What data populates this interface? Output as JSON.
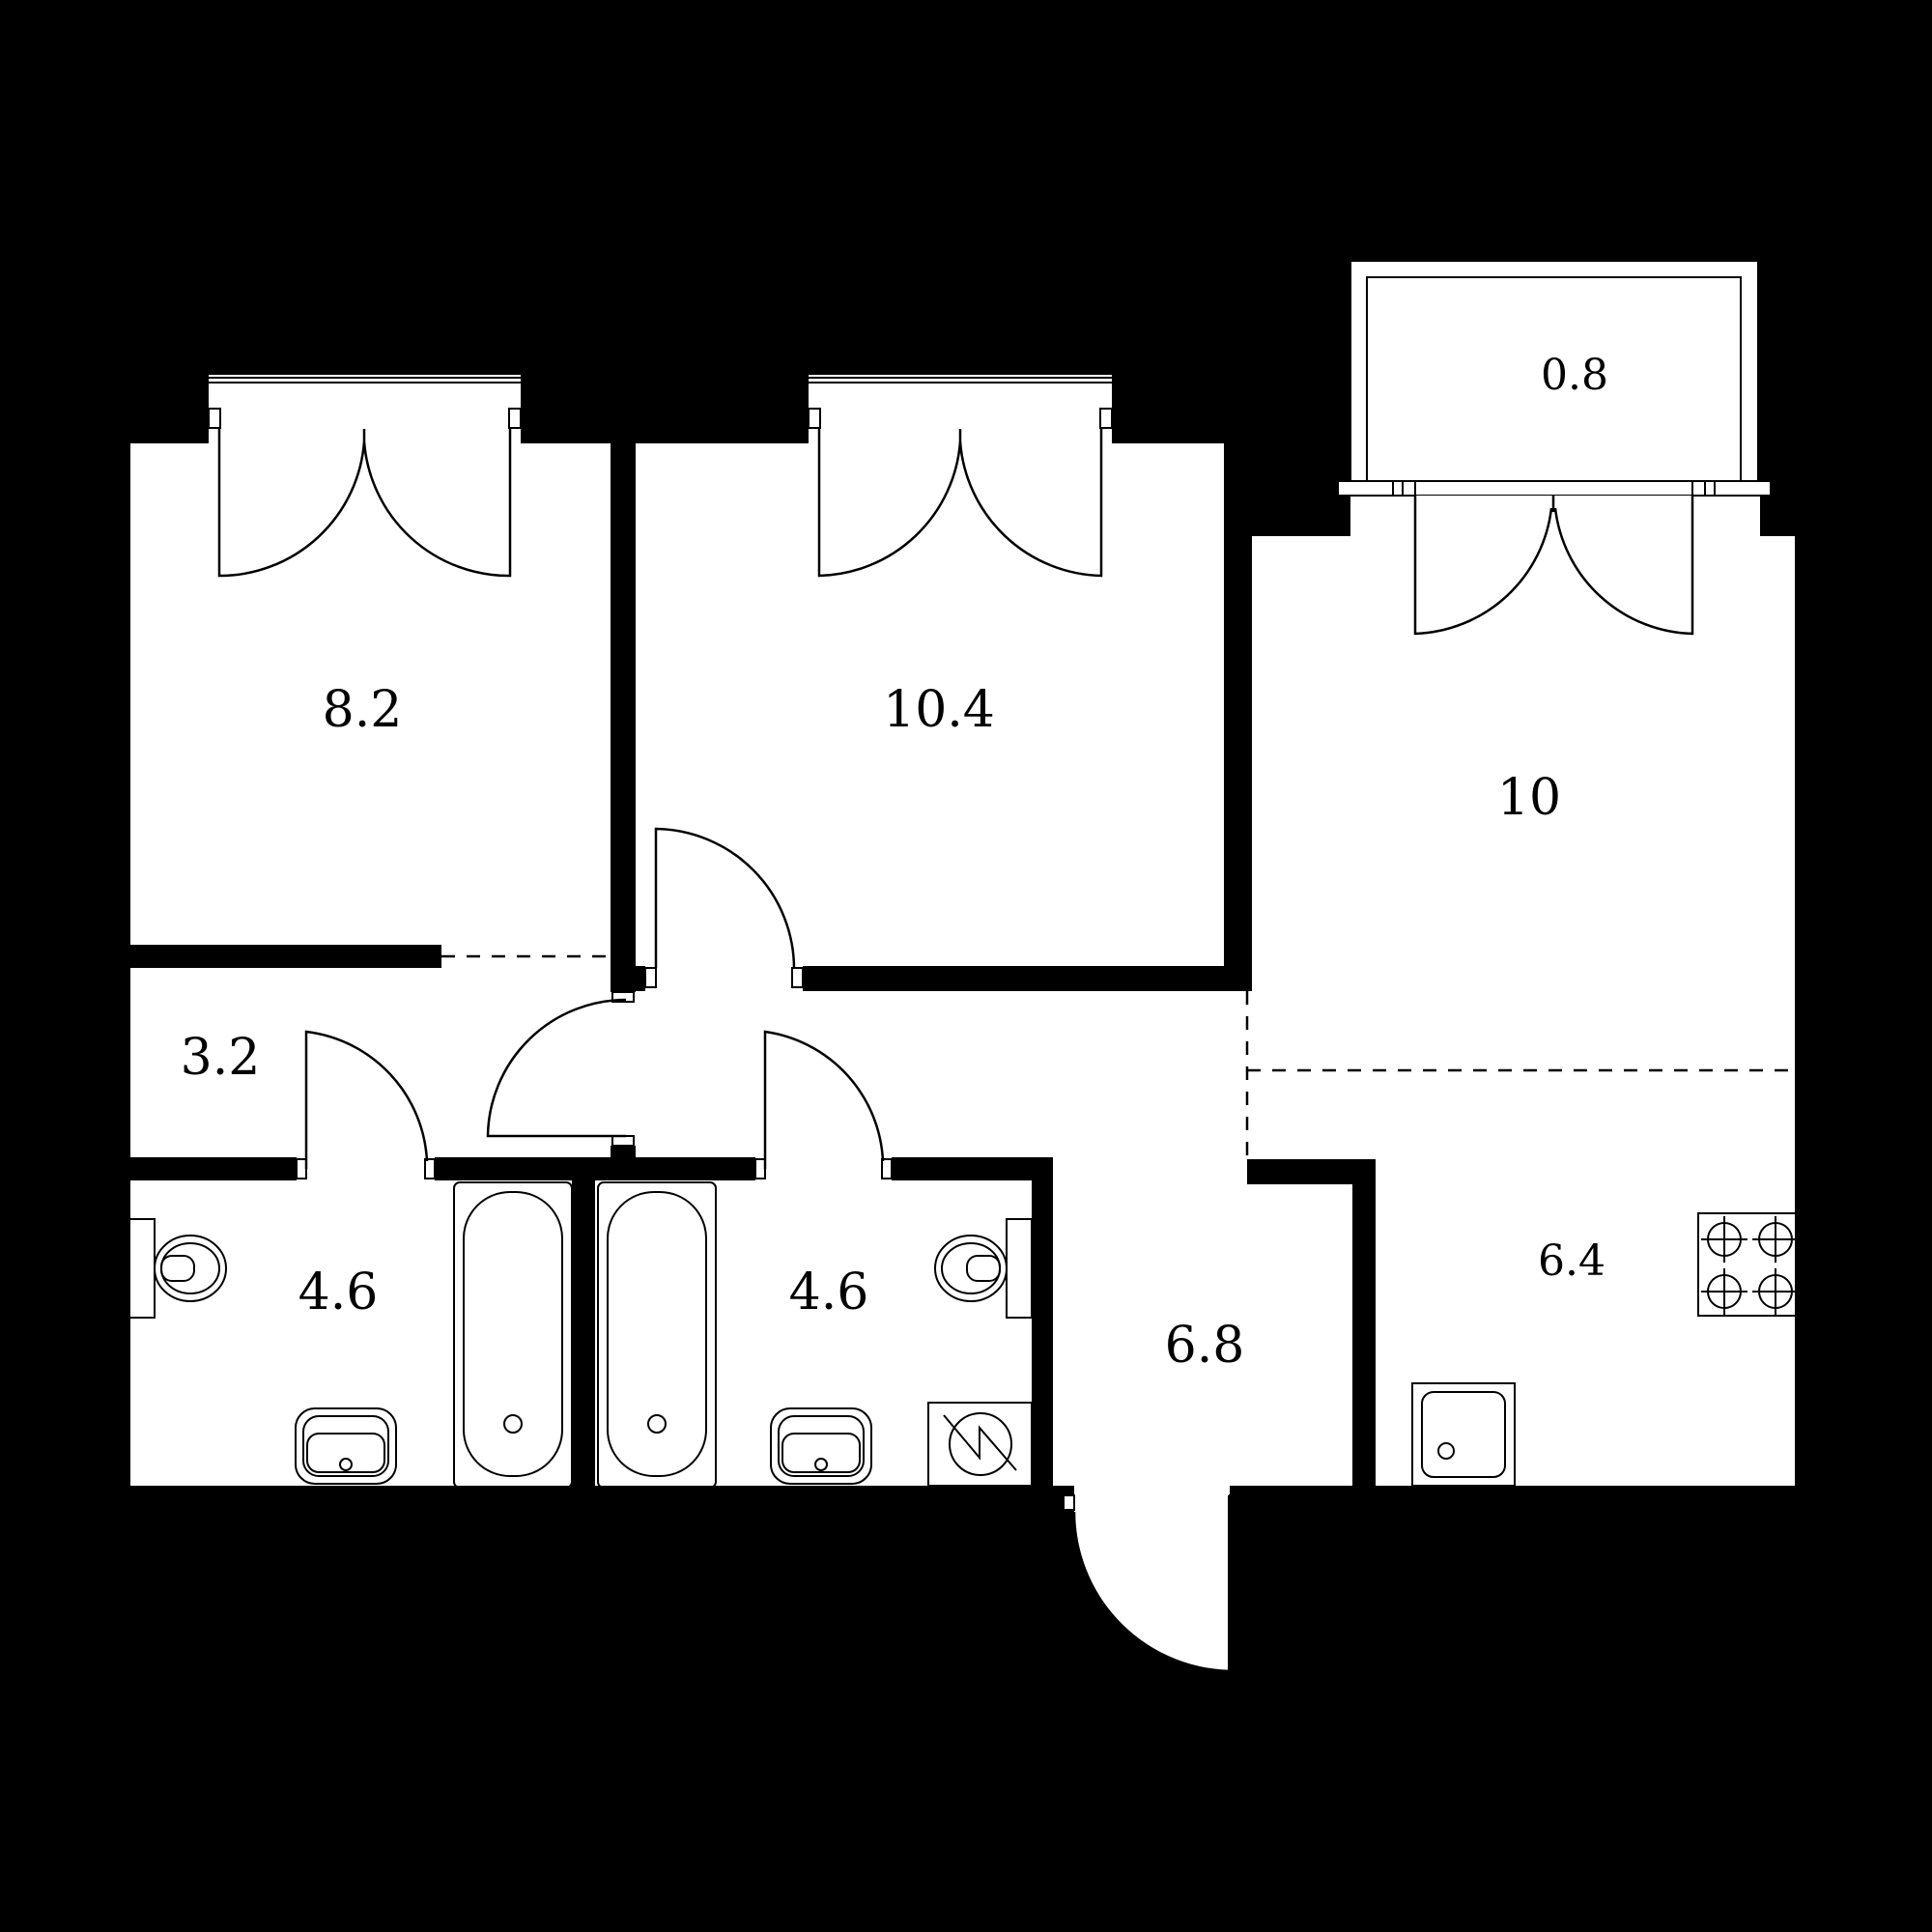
{
  "plan": {
    "type": "apartment-floor-plan",
    "units": "square-meters-per-room"
  },
  "colors": {
    "background": "#000000",
    "floor": "#ffffff",
    "walls": "#000000",
    "lines": "#000000"
  },
  "rooms": [
    {
      "key": "bedroom-left",
      "area": "8.2"
    },
    {
      "key": "bedroom-middle",
      "area": "10.4"
    },
    {
      "key": "living-room",
      "area": "10"
    },
    {
      "key": "balcony",
      "area": "0.8"
    },
    {
      "key": "corridor",
      "area": "3.2"
    },
    {
      "key": "bathroom-left",
      "area": "4.6"
    },
    {
      "key": "bathroom-right",
      "area": "4.6"
    },
    {
      "key": "hallway",
      "area": "6.8"
    },
    {
      "key": "kitchen",
      "area": "6.4"
    }
  ],
  "fixtures": [
    "toilet-icon",
    "toilet-icon",
    "pedestal-sink-icon",
    "pedestal-sink-icon",
    "bathtub-icon",
    "bathtub-icon",
    "washing-machine-icon",
    "stove-icon",
    "kitchen-sink-icon",
    "window-icon",
    "window-icon",
    "balcony-door-icon",
    "door-swing-icon",
    "door-swing-icon",
    "door-swing-icon",
    "door-swing-icon",
    "entrance-door-icon"
  ]
}
